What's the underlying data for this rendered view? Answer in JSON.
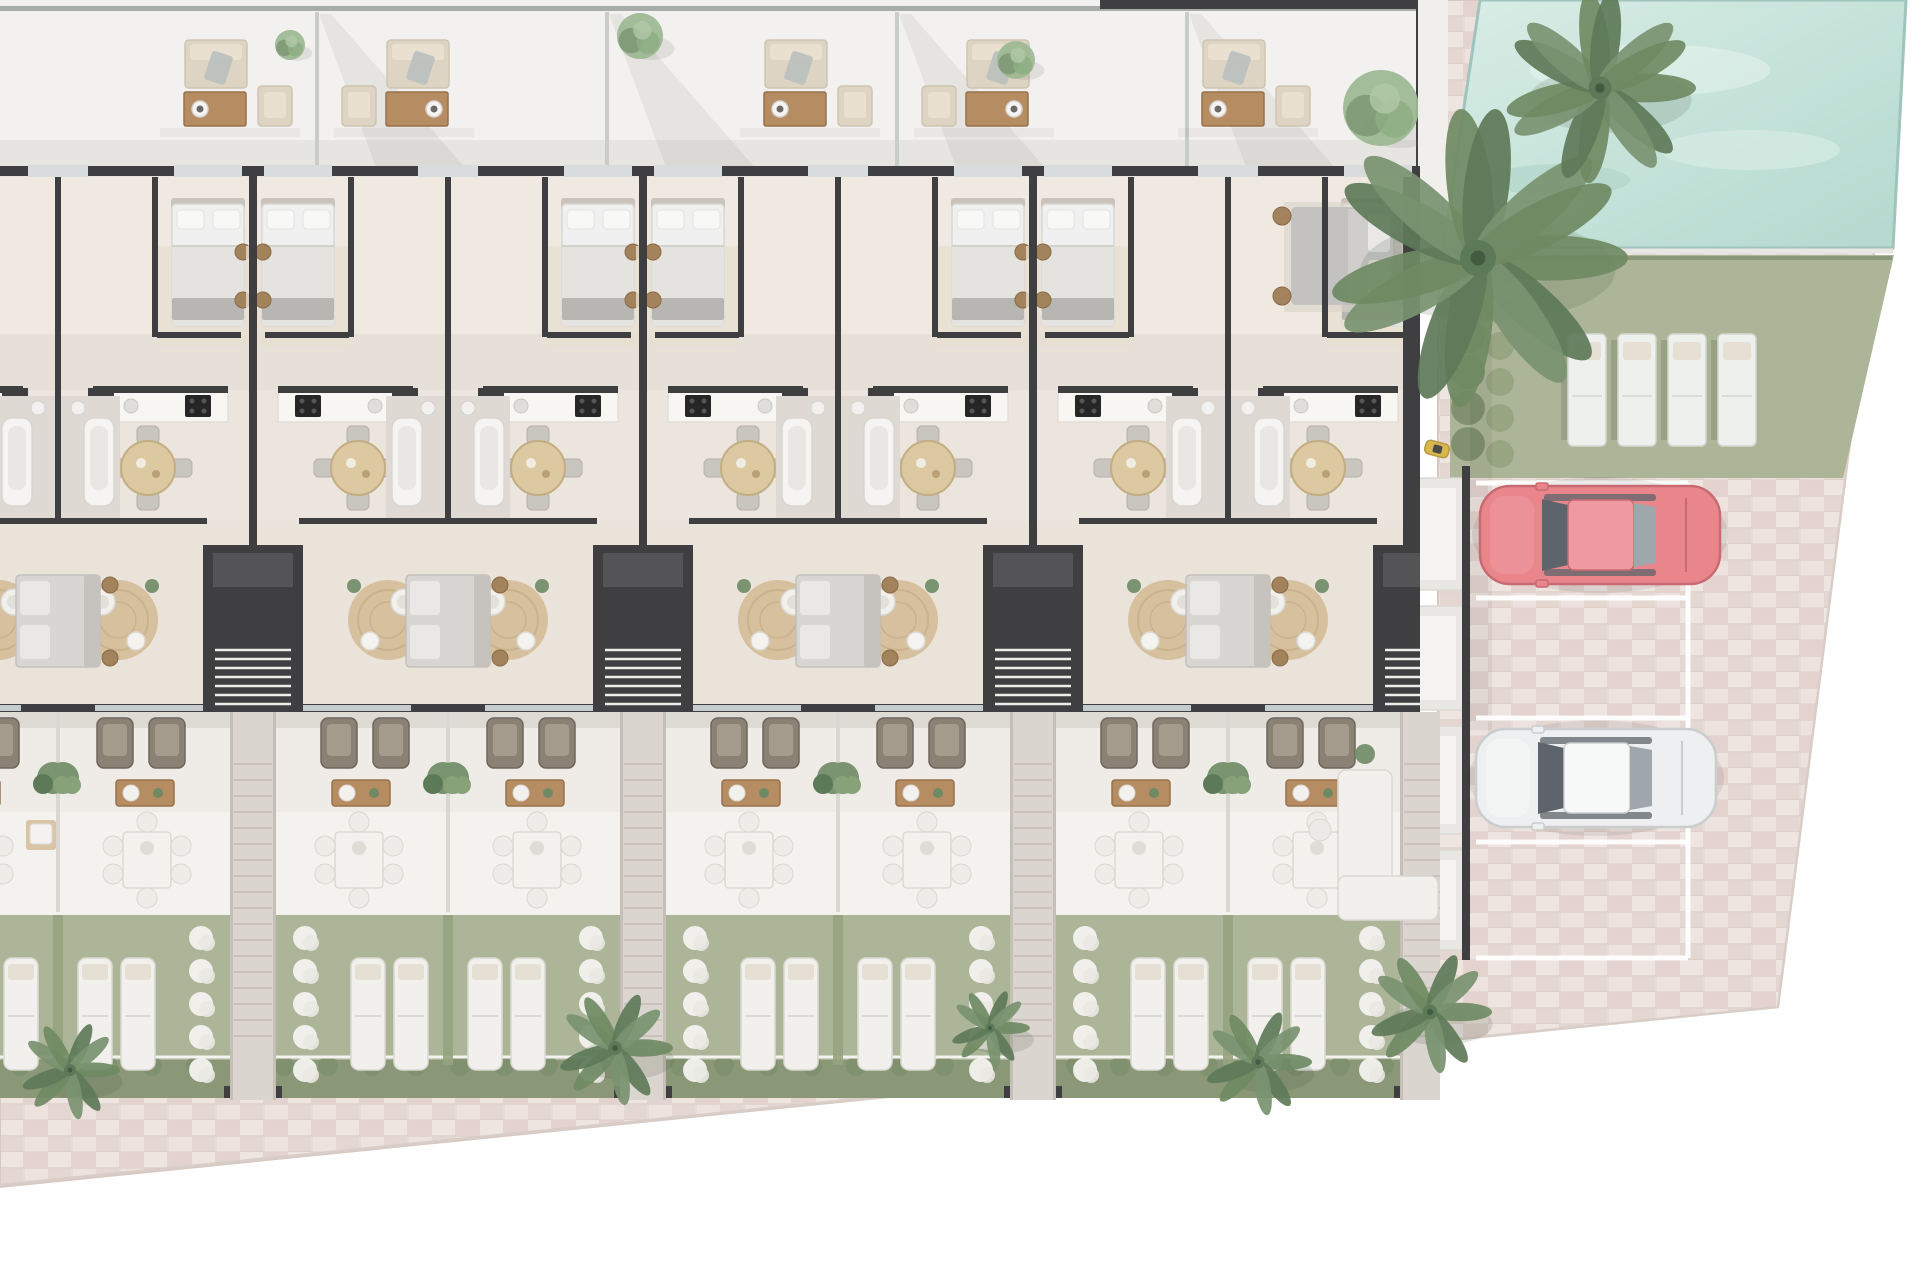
{
  "scene": {
    "canvas": {
      "width": 1920,
      "height": 1280
    },
    "palette": {
      "wall": "#3f3e40",
      "wallSoft": "#545356",
      "floor": "#ece5dd",
      "floorBed": "#efe9e1",
      "floorHall": "#e6e0d8",
      "floorLow": "#eae3da",
      "floorGray": "#dcd9d5",
      "bath": "#ded9d2",
      "roof": "#f3f1ef",
      "parapet": "#a9adaa",
      "divider": "#c9ccc8",
      "terrace": "#efece7",
      "patio": "#f4f2ee",
      "grass": "#acb597",
      "hedge": "#8b9878",
      "bush": "#7e8f6d",
      "bushLight": "#96a37f",
      "pool1": "#d8ede6",
      "pool2": "#b4d9ce",
      "poolEdge": "#9fc4bb",
      "deck": "#f1efec",
      "coping": "#e8e6e2",
      "pav": "#e8dbd6",
      "pavD": "#ddcac4",
      "pavL": "#f0e6e2",
      "pavLine": "#d8c6c0",
      "path": "#dad5cf",
      "pathEdge": "#c5bfb7",
      "step": "#c8c2ba",
      "white": "#f5f4f2",
      "furn": "#f1f0ed",
      "furnLine": "#dbd8d3",
      "furnShade": "#e5dfd4",
      "woodT": "#dcc9a2",
      "woodTline": "#c3ad82",
      "woodD": "#b68d62",
      "woodDline": "#97714b",
      "rug": "#d6c09e",
      "rugLine": "#c9b28c",
      "sofaBeige": "#ded4c3",
      "sofaLine": "#cfc4b0",
      "sofaCushion": "#e9e0d0",
      "brown": "#8b8175",
      "brownD": "#6e675d",
      "cushion": "#a59c8e",
      "bedBase": "#eff0ef",
      "duvet": "#e5e3df",
      "pillow": "#f8f8f6",
      "throw": "#b8b6b2",
      "head": "#c9c3bb",
      "bedRug": "#e8dfd2",
      "grayBed": "#d8d6d3",
      "grayBedLine": "#c3c0bc",
      "grayPillow": "#e9e8e6",
      "black": "#262626",
      "pouf": "#a3835c",
      "poufDark": "#8a6a45",
      "green": "#7a9370",
      "greenD": "#5d7a58",
      "greenL": "#9eb894",
      "palm": "#6f8a63",
      "carRed": "#e8868c",
      "carRedD": "#c96a72",
      "carRedL": "#ef9aa0",
      "carWhite": "#edeff0",
      "carWhiteD": "#c9cdce",
      "carWhiteL": "#f7f8f8",
      "glass": "#5e646b",
      "glassL": "#9fa7ac",
      "winGap": "#d8dcdc",
      "doorGap": "#c6cbcb",
      "scooter": "#d8b84e",
      "propLine": "#d9cdc7"
    },
    "roof": {
      "h": 170,
      "endX": 1418,
      "parapetY": 6,
      "topBar": {
        "x": 1100,
        "w": 318
      },
      "dividers": [
        317,
        607,
        897,
        1187
      ],
      "clusters": [
        {
          "cx": 230,
          "s": 1
        },
        {
          "cx": 404,
          "s": -1
        },
        {
          "cx": 810,
          "s": 1
        },
        {
          "cx": 984,
          "s": -1
        },
        {
          "cx": 1248,
          "s": 1
        }
      ],
      "trees": [
        [
          290,
          45,
          15
        ],
        [
          640,
          36,
          23
        ],
        [
          1016,
          60,
          19
        ],
        [
          1381,
          108,
          38
        ]
      ]
    },
    "building": {
      "x0": 0,
      "x1": 1420,
      "top": 170,
      "bottom": 712,
      "rightWallX": 1403,
      "cores": [
        -137,
        253,
        643,
        1033,
        1423
      ],
      "mids": [
        58,
        448,
        838,
        1228
      ]
    },
    "unit": {
      "bedOff": 45,
      "bedW": 74,
      "poufOff": 10,
      "cookOff": 55,
      "counter": [
        25,
        145
      ],
      "colOff": 152,
      "diningOff": 105,
      "rugOff": 135,
      "chairOffs": [
        86,
        138
      ],
      "ctableOff": 108,
      "plantOff": 200,
      "patioOff": 106,
      "loungerOffs": [
        115,
        158
      ],
      "padOff": 52,
      "pathW": 46,
      "shaftW": 100
    },
    "bands": {
      "terraceY": 712,
      "patioY": 812,
      "gardenY": 915,
      "hedgeY": 1060,
      "gardenBottom": 1098,
      "outClipX": 1440
    },
    "pool": {
      "poly": [
        [
          1480,
          0
        ],
        [
          1906,
          0
        ],
        [
          1893,
          248
        ],
        [
          1443,
          248
        ]
      ],
      "deck": [
        1418,
        0,
        30,
        252
      ],
      "copingY": 251,
      "lawnPoly": [
        [
          1450,
          255
        ],
        [
          1894,
          255
        ],
        [
          1843,
          478
        ],
        [
          1450,
          478
        ]
      ],
      "hedgeCol": {
        "x": 1462,
        "y0": 264,
        "n": 6,
        "step": 36
      },
      "loungers": {
        "x0": 1568,
        "step": 50,
        "n": 4,
        "y": 334,
        "w": 38,
        "h": 112
      }
    },
    "parking": {
      "x0": 1476,
      "x1": 1688,
      "lines": [
        483,
        598,
        718,
        842,
        958
      ],
      "wallX": 1462,
      "porches": [
        [
          470,
          598
        ],
        [
          598,
          718
        ],
        [
          718,
          842
        ],
        [
          842,
          958
        ]
      ],
      "cars": [
        {
          "x": 1480,
          "y": 486,
          "len": 240,
          "wid": 98,
          "body": "red"
        },
        {
          "x": 1476,
          "y": 729,
          "len": 240,
          "wid": 98,
          "body": "white"
        }
      ],
      "scooter": [
        1437,
        449
      ]
    },
    "paving": {
      "outer": [
        [
          1446,
          0
        ],
        [
          1906,
          0
        ],
        [
          1778,
          1007
        ],
        [
          0,
          1187
        ],
        [
          0,
          1096
        ],
        [
          1438,
          1030
        ],
        [
          1438,
          170
        ],
        [
          1446,
          170
        ]
      ],
      "edgeLines": [
        [
          [
            1906,
            2
          ],
          [
            1778,
            1007
          ]
        ],
        [
          [
            1778,
            1007
          ],
          [
            0,
            1185
          ]
        ]
      ]
    },
    "palms": {
      "pool": [
        [
          1478,
          258,
          150
        ],
        [
          1600,
          88,
          96
        ]
      ],
      "bottom": [
        [
          70,
          1070,
          50
        ],
        [
          615,
          1048,
          58
        ],
        [
          990,
          1028,
          40
        ],
        [
          1258,
          1062,
          54
        ],
        [
          1430,
          1012,
          62
        ]
      ]
    },
    "rightEnd": {
      "bed": {
        "x": 1292,
        "y": 208,
        "w": 110,
        "h": 96
      },
      "sofaL": [
        1338,
        770
      ]
    }
  }
}
